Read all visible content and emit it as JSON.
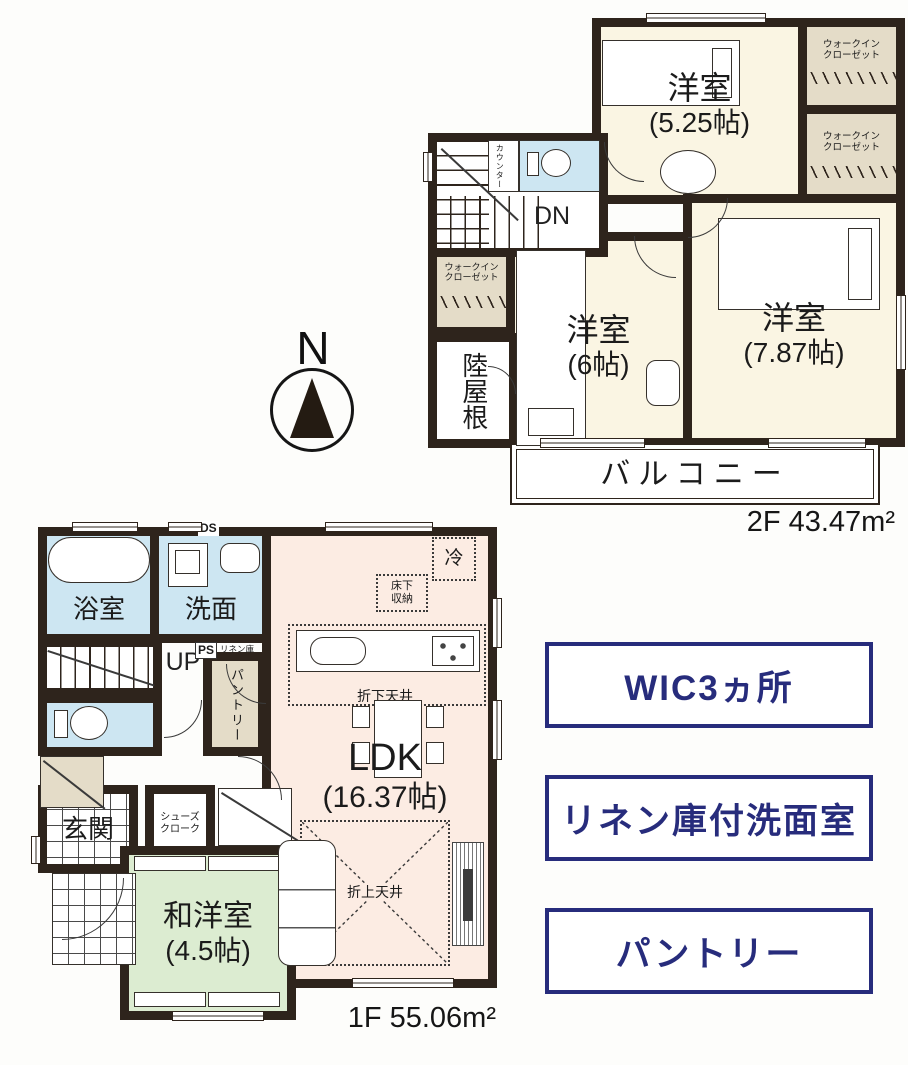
{
  "compass": {
    "n": "N"
  },
  "f2": {
    "bedroom_525": {
      "name": "洋室",
      "size": "(5.25帖)"
    },
    "bedroom_6": {
      "name": "洋室",
      "size": "(6帖)"
    },
    "bedroom_787": {
      "name": "洋室",
      "size": "(7.87帖)"
    },
    "wic": "ウォークイン\nクローゼット",
    "counter": "カウンター",
    "dn": "DN",
    "flat_roof": "陸屋根",
    "balcony": "バルコニー",
    "area": "2F 43.47m²"
  },
  "f1": {
    "bath": "浴室",
    "wash": "洗面",
    "ds": "DS",
    "up": "UP",
    "ps": "PS",
    "linen": "リネン庫",
    "pantry": "パントリー",
    "entrance": "玄関",
    "shoe_cloak": "シューズ\nクローク",
    "ldk": {
      "name": "LDK",
      "size": "(16.37帖)"
    },
    "washitsu": {
      "name": "和洋室",
      "size": "(4.5帖)"
    },
    "fridge": "冷",
    "floor_storage": "床下\n収納",
    "lowered_ceiling": "折下天井",
    "raised_ceiling": "折上天井",
    "area": "1F 55.06m²"
  },
  "features": [
    {
      "label": "WIC3ヵ所"
    },
    {
      "label": "リネン庫付洗面室"
    },
    {
      "label": "パントリー"
    }
  ],
  "colors": {
    "wall": "#2e241c",
    "room_cream": "#faf5e3",
    "closet_beige": "#e4dcc8",
    "water_blue": "#cde6f2",
    "ldk_pink": "#fcece3",
    "tatami_green": "#dcecd1",
    "accent_navy": "#272c7c"
  }
}
